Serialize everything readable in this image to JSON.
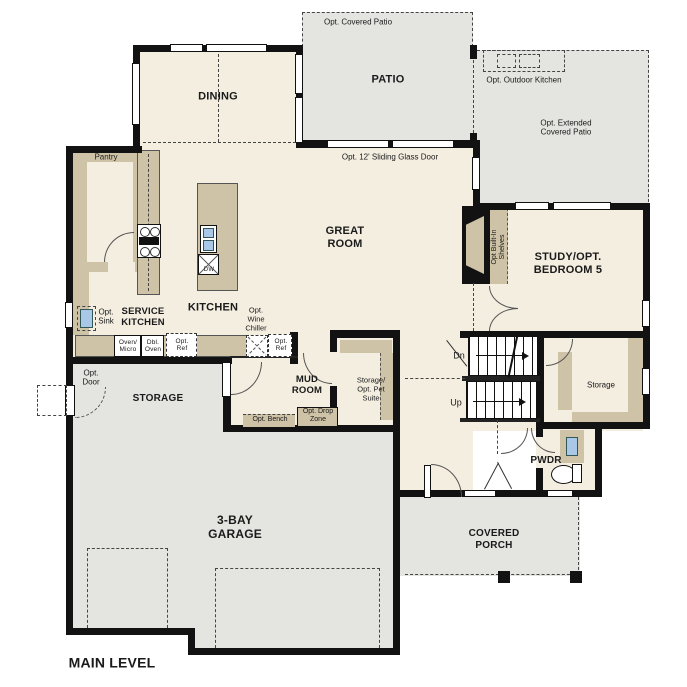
{
  "title": "MAIN LEVEL",
  "labels": {
    "dining": "DINING",
    "patio": "PATIO",
    "opt_covered_patio": "Opt. Covered Patio",
    "opt_outdoor_kitchen": "Opt. Outdoor Kitchen",
    "opt_extended_patio": "Opt. Extended\nCovered Patio",
    "sliding_door": "Opt. 12' Sliding Glass Door",
    "great_room": "GREAT\nROOM",
    "kitchen": "KITCHEN",
    "service_kitchen": "SERVICE\nKITCHEN",
    "pantry": "Pantry",
    "opt_sink": "Opt.\nSink",
    "opt_wine_chiller": "Opt.\nWine\nChiller",
    "oven_micro": "Oven/\nMicro",
    "dbl_oven": "Dbl.\nOven",
    "opt_ref_1": "Opt.\nRef",
    "opt_ref_2": "Opt.\nRef",
    "dw": "DW",
    "storage_garage": "STORAGE",
    "opt_door": "Opt.\nDoor",
    "garage": "3-BAY\nGARAGE",
    "mud_room": "MUD\nROOM",
    "pet_suite": "Storage/\nOpt. Pet\nSuite",
    "opt_bench": "Opt. Bench",
    "opt_drop_zone": "Opt. Drop\nZone",
    "dn": "Dn",
    "up": "Up",
    "storage_stairs": "Storage",
    "opt_shelves": "Opt Built-In\nShelves",
    "study": "STUDY/OPT.\nBEDROOM 5",
    "pwdr": "PWDR",
    "covered_porch": "COVERED\nPORCH",
    "main_level": "MAIN LEVEL"
  },
  "colors": {
    "wall": "#121212",
    "floor": "#f4eee1",
    "cabinet": "#cfc3a7",
    "outdoor": "#e4e4e1",
    "fixture": "#a9c7e7"
  }
}
